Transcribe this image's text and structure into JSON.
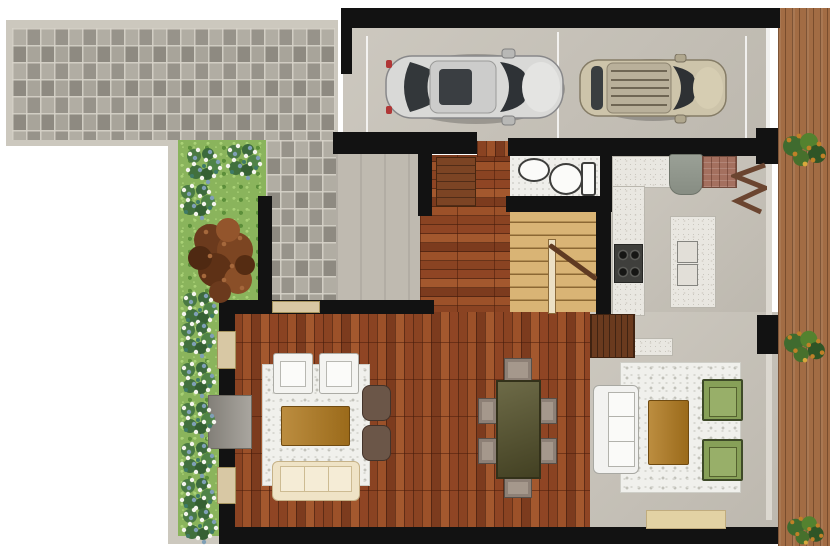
{
  "scene": {
    "type": "architectural floor plan, top-down 3D render",
    "floor": "ground floor"
  },
  "palette": {
    "wall": "#121212",
    "hardwood": "#8f4524",
    "stair_wood": "#d9b475",
    "concrete": "#c7c2b8",
    "cobblestone": "#a29e94",
    "deck_wood": "#a26c44",
    "lawn": "#8ab45c",
    "shag_rug": "#f0f0ec",
    "green_armchair": "#87a058",
    "amber_table": "#b0791e",
    "cream_sofa": "#efe3c6",
    "white_sofa": "#f2f2f0",
    "window_frame": "#d8c8a4"
  },
  "rooms": {
    "driveway": {
      "label": "Cobblestone driveway and walkway"
    },
    "garden": {
      "label": "Side garden with lawn and flower beds",
      "flower_beds": 10,
      "large_shrubs": 1
    },
    "garage": {
      "label": "Two-car garage",
      "bays": 2,
      "cars": [
        {
          "label": "silver sedan"
        },
        {
          "label": "beige SUV"
        }
      ]
    },
    "porch": {
      "label": "Entry porch"
    },
    "hall": {
      "label": "Entry hall",
      "furniture": [
        "dark wood cabinet"
      ]
    },
    "bathroom": {
      "label": "Guest bathroom",
      "fixtures": [
        "sink",
        "toilet"
      ]
    },
    "stairs": {
      "label": "Staircase to upper floor",
      "treads": 8
    },
    "kitchen": {
      "label": "Kitchen",
      "furniture": [
        "L-shaped marble counter",
        "four-burner cooktop",
        "refrigerator",
        "brick pantry cabinet",
        "island with double sink",
        "zigzag shelf"
      ]
    },
    "dining": {
      "label": "Dining area",
      "seats": 6,
      "furniture": [
        "dark wood dining table"
      ]
    },
    "family_room": {
      "label": "Family room",
      "furniture": [
        "two white armchairs",
        "amber coffee table",
        "two brown ottomans",
        "cream three-seat sofa",
        "white shag rug",
        "wall media console"
      ]
    },
    "living_room": {
      "label": "Living room",
      "furniture": [
        "white three-seat sofa",
        "amber coffee table",
        "two green armchairs",
        "white shag rug",
        "beige bench"
      ]
    },
    "deck": {
      "label": "Side wood deck",
      "planters": 3
    }
  }
}
